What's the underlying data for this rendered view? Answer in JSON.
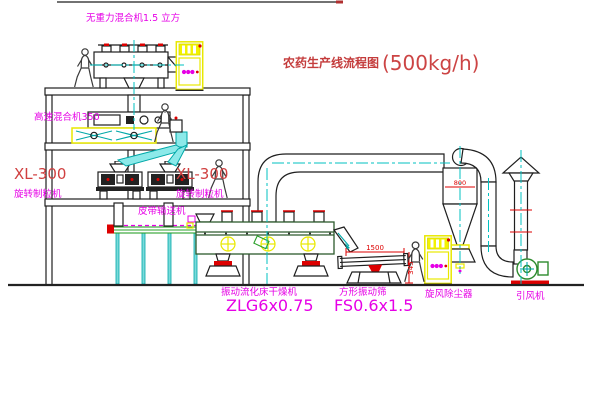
{
  "diagram": {
    "title": "农药生产线流程图",
    "title_capacity": "(500kg/h)",
    "labels": {
      "zero_gravity_mixer": "无重力混合机1.5 立方",
      "high_speed_mixer": "高速混合机350",
      "granulator_left_model": "XL-300",
      "granulator_left_name": "旋转制粒机",
      "granulator_right_model": "XL-300",
      "granulator_right_name": "旋转制粒机",
      "belt_conveyor": "皮带输送机",
      "dryer_name": "振动流化床干燥机",
      "dryer_model": "ZLG6x0.75",
      "screen_name": "方形振动筛",
      "screen_model": "FS0.6x1.5",
      "cyclone": "旋风除尘器",
      "fan": "引风机"
    },
    "dimensions": {
      "screen_width": "1500",
      "cyclone_body": "800",
      "screen_height": "345"
    },
    "colors": {
      "label_magenta": "#e600e6",
      "title_red": "#c43c3c",
      "dimension_red": "#dd0000",
      "centerline_cyan": "#00c2c2",
      "cabinet_yellow": "#e8e800",
      "machine_green": "#2e8b2e",
      "line_black": "#1f1f1f"
    }
  }
}
